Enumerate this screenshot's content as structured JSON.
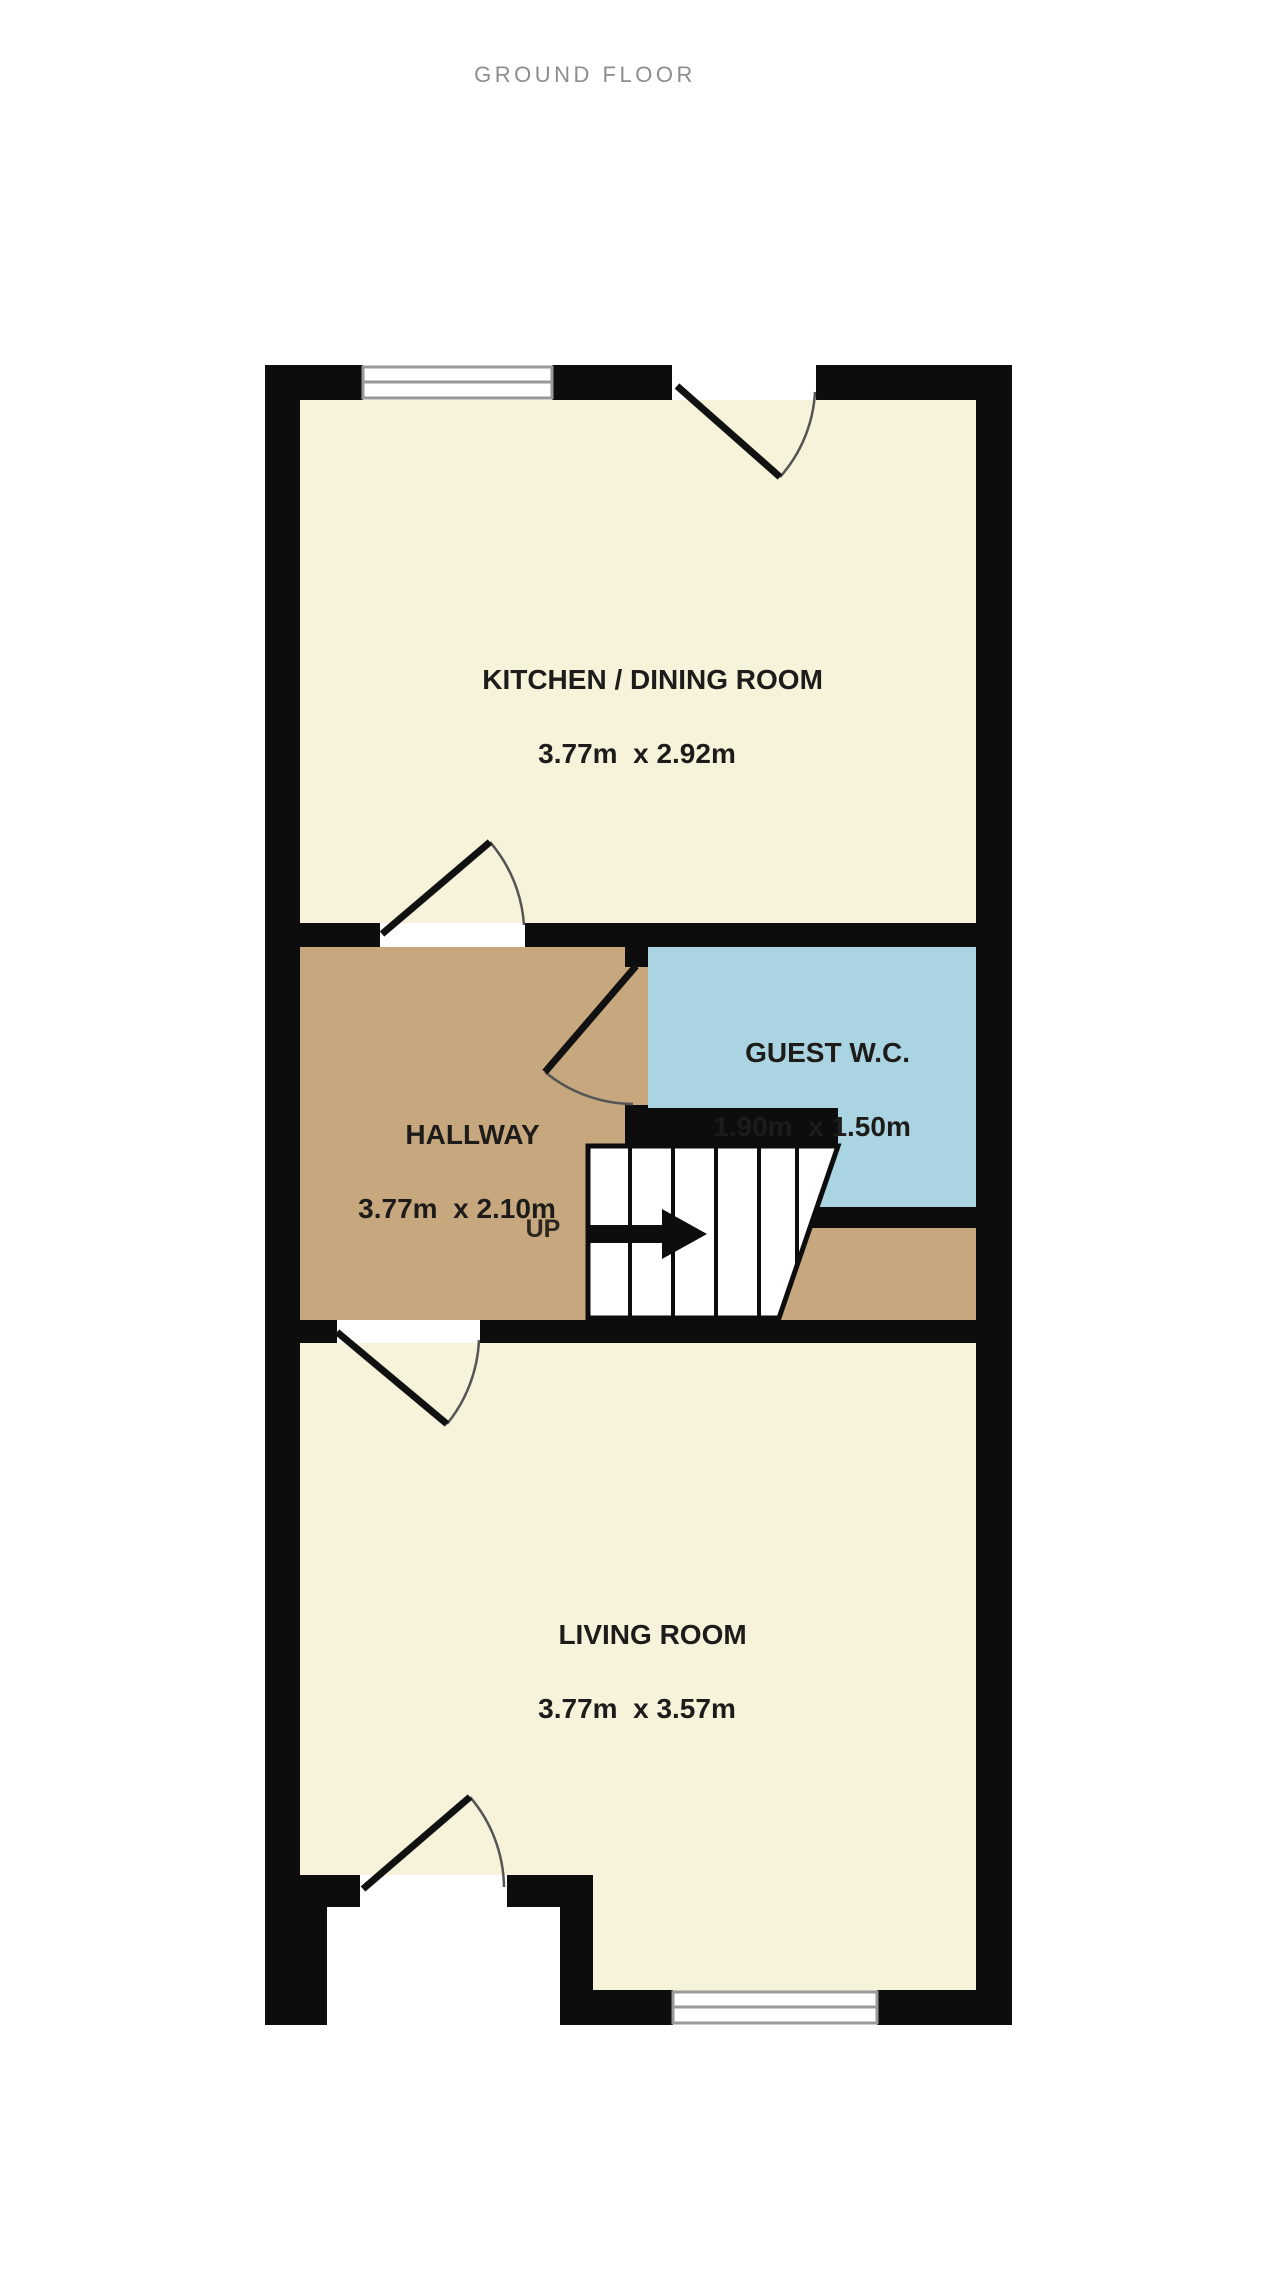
{
  "title": "GROUND FLOOR",
  "rooms": [
    {
      "id": "kitchen",
      "name": "KITCHEN / DINING ROOM",
      "dims": "3.77m  x 2.92m"
    },
    {
      "id": "guest-wc",
      "name": "GUEST W.C.",
      "dims": "1.90m  x 1.50m"
    },
    {
      "id": "hallway",
      "name": "HALLWAY",
      "dims": "3.77m  x 2.10m"
    },
    {
      "id": "living",
      "name": "LIVING ROOM",
      "dims": "3.77m  x 3.57m"
    }
  ],
  "stairs": {
    "label": "UP"
  },
  "colors": {
    "wall": "#0d0d0d",
    "kitchen_floor": "#f7f3da",
    "living_floor": "#f7f3da",
    "hallway_floor": "#c7a87e",
    "wc_floor": "#abd4e2",
    "window_frame": "#999999",
    "door_arc": "#555555",
    "label_text": "#1d1c1a",
    "title_text": "#8d8d8d",
    "outside": "#ffffff"
  }
}
